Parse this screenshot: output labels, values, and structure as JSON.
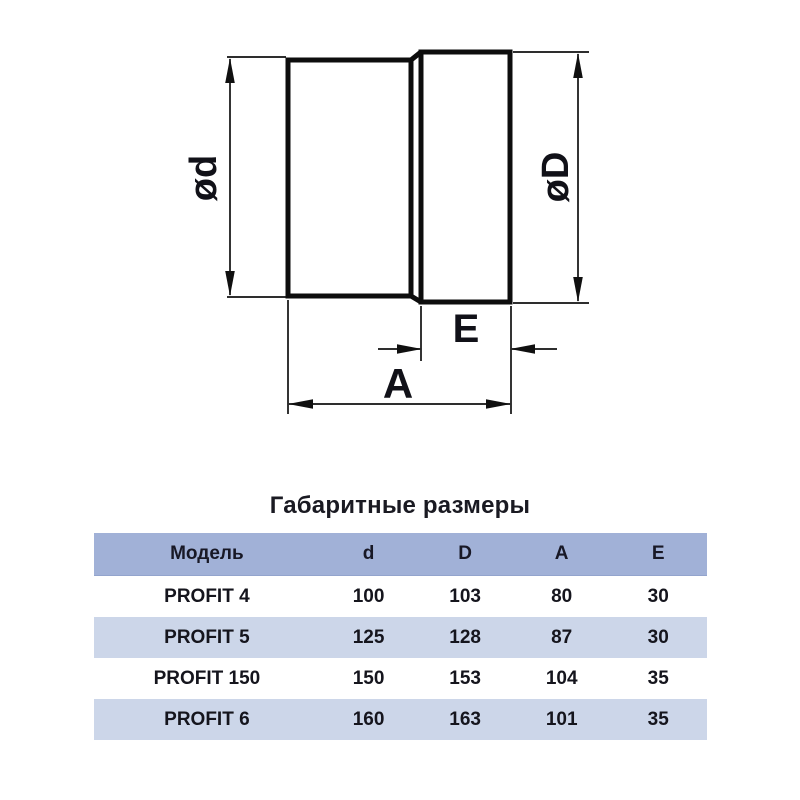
{
  "title": "Габаритные размеры",
  "diagram": {
    "label_d": "ød",
    "label_D": "øD",
    "label_E": "E",
    "label_A": "A"
  },
  "table": {
    "headers": [
      "Модель",
      "d",
      "D",
      "A",
      "E"
    ],
    "rows": [
      [
        "PROFIT 4",
        "100",
        "103",
        "80",
        "30"
      ],
      [
        "PROFIT 5",
        "125",
        "128",
        "87",
        "30"
      ],
      [
        "PROFIT 150",
        "150",
        "153",
        "104",
        "35"
      ],
      [
        "PROFIT 6",
        "160",
        "163",
        "101",
        "35"
      ]
    ]
  },
  "colors": {
    "header_bg": "#a1b1d7",
    "stripe_bg": "#ccd6e9",
    "row_bg": "#ffffff",
    "text": "#15151d",
    "line": "#101010"
  },
  "chart_data": {
    "type": "table",
    "title": "Габаритные размеры",
    "columns": [
      "Модель",
      "d",
      "D",
      "A",
      "E"
    ],
    "rows": [
      [
        "PROFIT 4",
        100,
        103,
        80,
        30
      ],
      [
        "PROFIT 5",
        125,
        128,
        87,
        30
      ],
      [
        "PROFIT 150",
        150,
        153,
        104,
        35
      ],
      [
        "PROFIT 6",
        160,
        163,
        101,
        35
      ]
    ]
  }
}
